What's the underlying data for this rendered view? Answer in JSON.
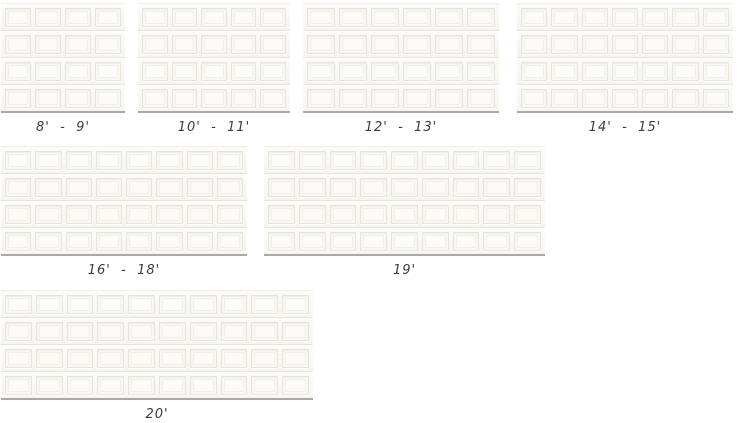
{
  "page": {
    "title": "Garage door width options",
    "background": "#ffffff"
  },
  "palette": {
    "door_face": "#f8f7f1",
    "panel_face": "#f9f8f2",
    "panel_inner": "#fcfbf7",
    "panel_groove": "#e6e3da",
    "panel_groove_light": "#f0eee7",
    "section_line": "#e6e4dc",
    "section_highlight": "#fdfdfb",
    "door_top_line": "#f0eee8",
    "ground_line": "#a9a9a7",
    "label_color": "#3b3b3b"
  },
  "doors": [
    {
      "label": "8'  -  9'",
      "panel_columns": 4,
      "panel_rows": 4,
      "layout": {
        "left": 1,
        "top": 3,
        "width": 124,
        "height": 110
      }
    },
    {
      "label": "10'  -  11'",
      "panel_columns": 5,
      "panel_rows": 4,
      "layout": {
        "left": 138,
        "top": 3,
        "width": 152,
        "height": 110
      }
    },
    {
      "label": "12'  -  13'",
      "panel_columns": 6,
      "panel_rows": 4,
      "layout": {
        "left": 303,
        "top": 3,
        "width": 196,
        "height": 110
      }
    },
    {
      "label": "14'  -  15'",
      "panel_columns": 7,
      "panel_rows": 4,
      "layout": {
        "left": 517,
        "top": 3,
        "width": 216,
        "height": 110
      }
    },
    {
      "label": "16'  -  18'",
      "panel_columns": 8,
      "panel_rows": 4,
      "layout": {
        "left": 1,
        "top": 146,
        "width": 246,
        "height": 110
      }
    },
    {
      "label": "19'",
      "panel_columns": 9,
      "panel_rows": 4,
      "layout": {
        "left": 264,
        "top": 146,
        "width": 281,
        "height": 110
      }
    },
    {
      "label": "20'",
      "panel_columns": 10,
      "panel_rows": 4,
      "layout": {
        "left": 1,
        "top": 290,
        "width": 312,
        "height": 110
      }
    }
  ]
}
